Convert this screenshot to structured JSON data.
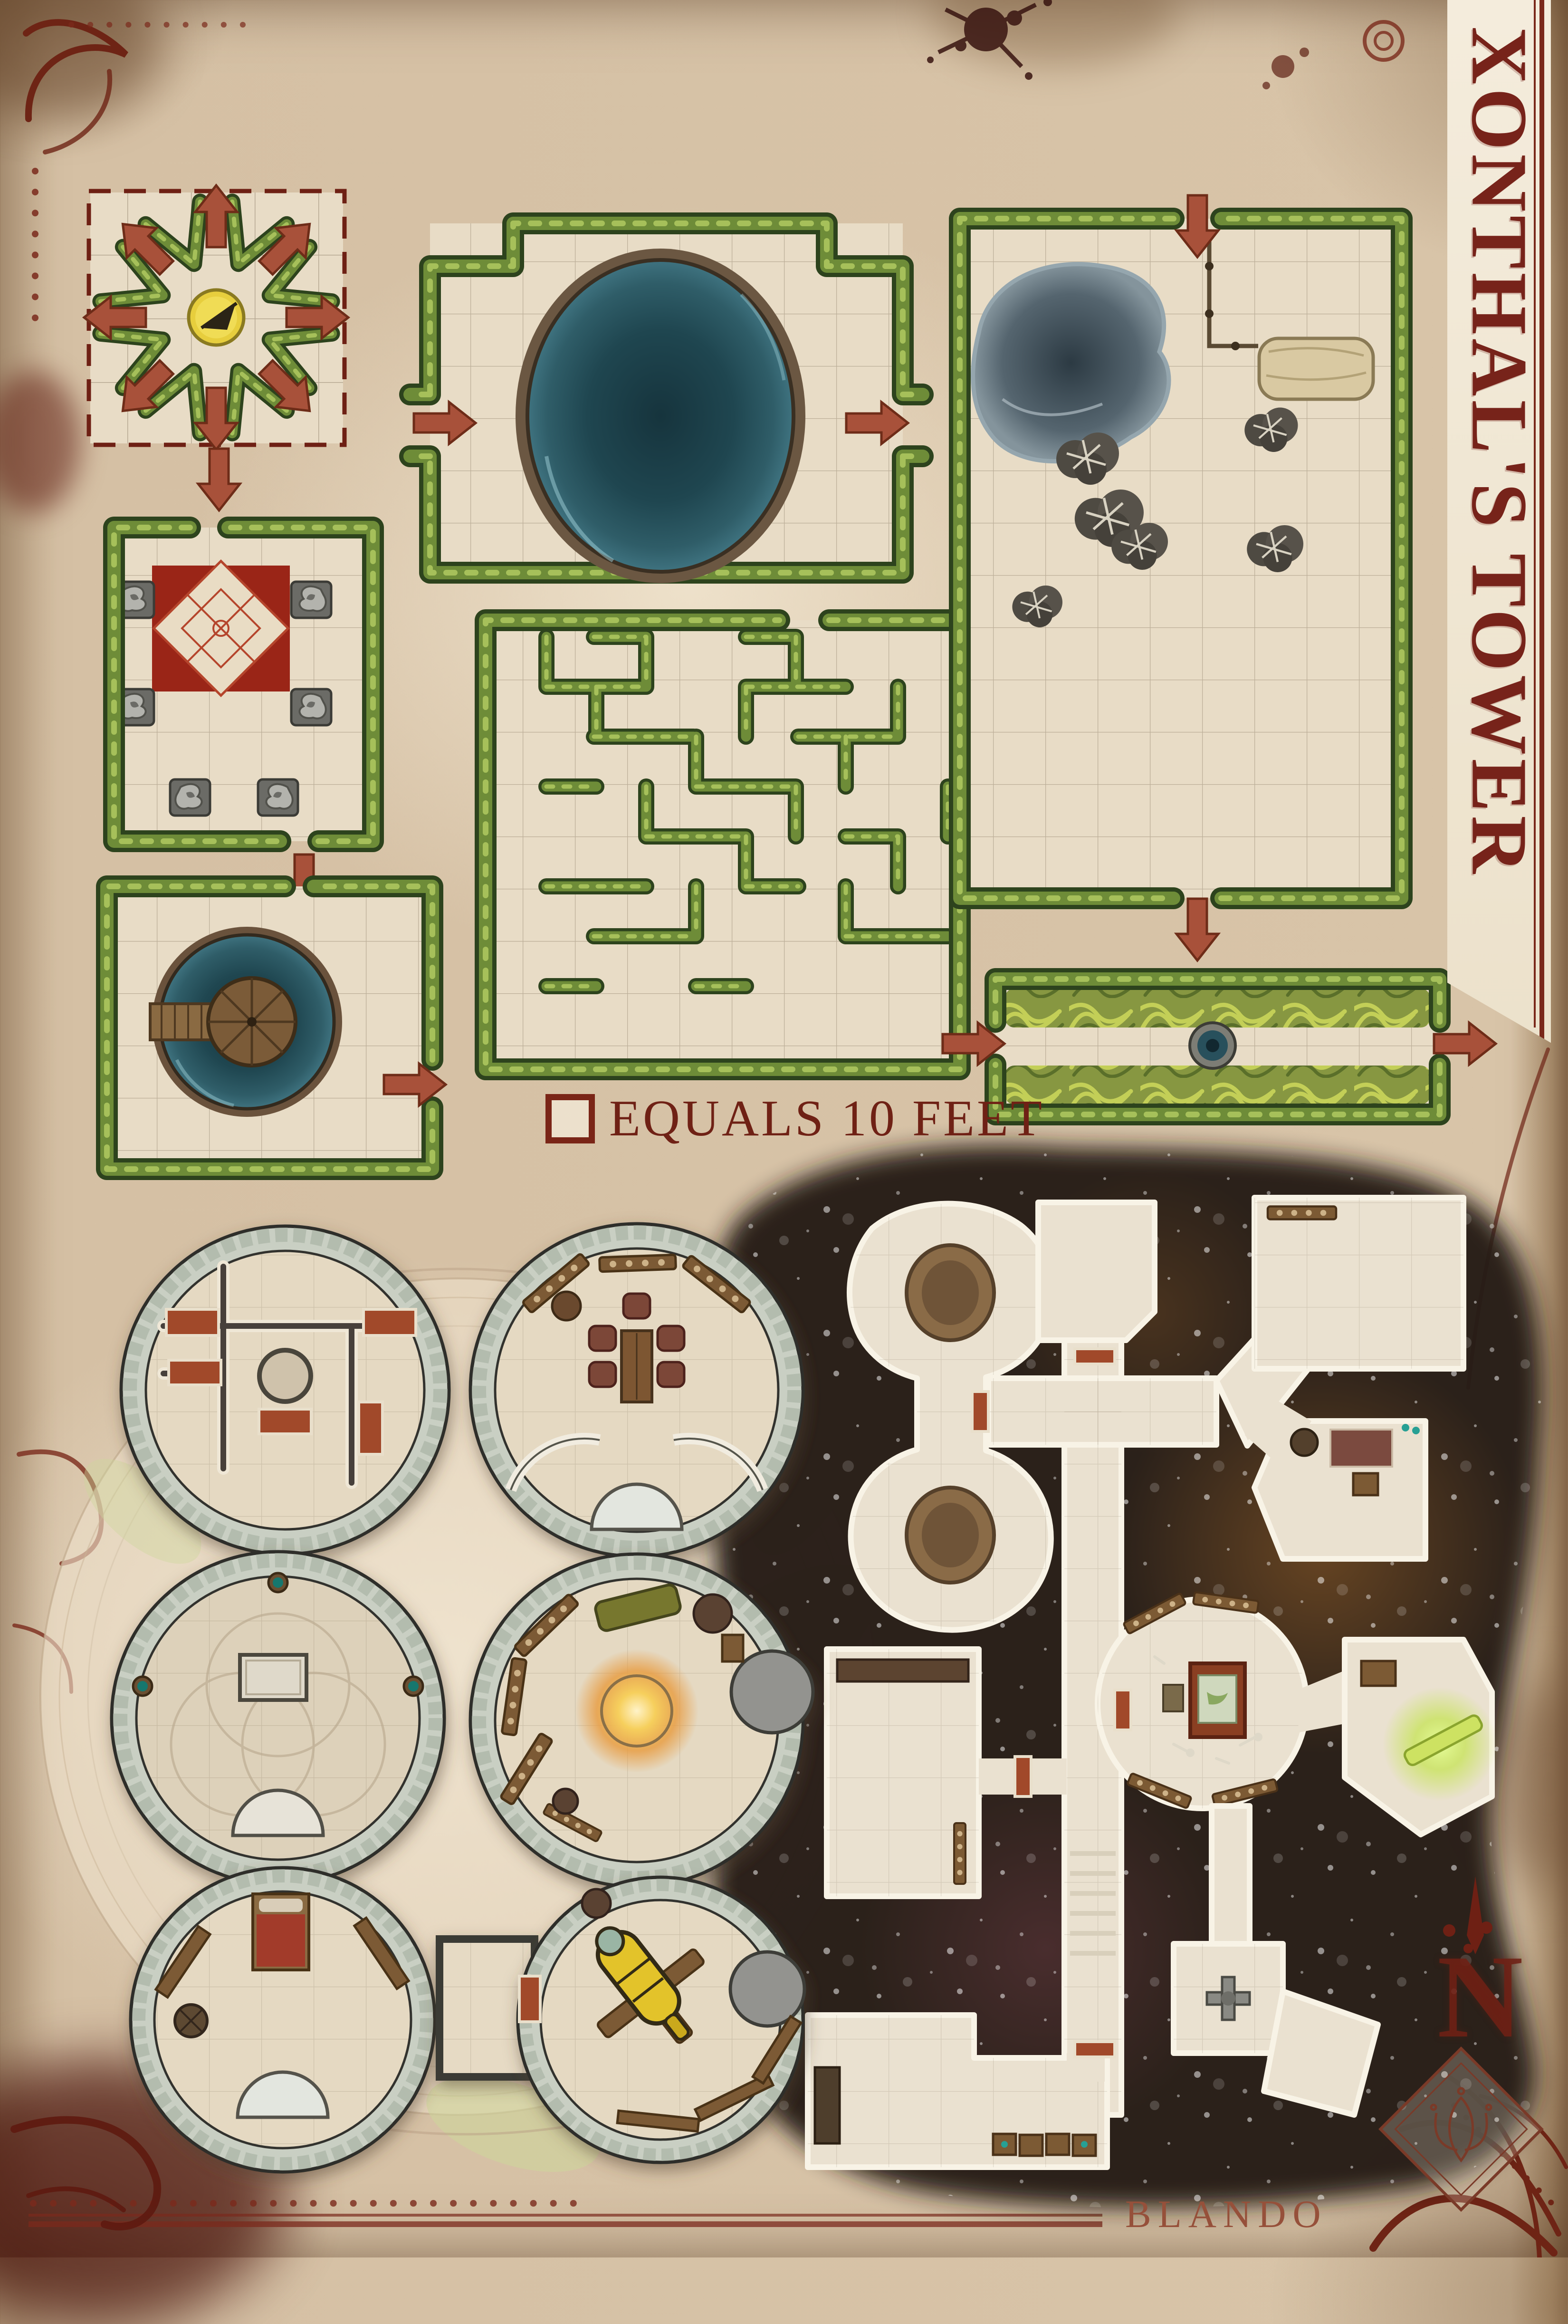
{
  "title": {
    "text": "XONTHAL'S TOWER"
  },
  "legend": {
    "symbol": "grid-square",
    "text": "EQUALS 10 FEET"
  },
  "credit": {
    "text": "BLANDO"
  },
  "compass": {
    "letter": "N",
    "direction": "north"
  },
  "palette": {
    "parchment": "#d5c0a4",
    "accent_maroon": "#77231a",
    "arrow_red": "#a8513a",
    "hedge_green": "#6e8c38",
    "pool_teal": "#1f4650",
    "carpet_red": "#9a2517",
    "tower_ring_gray": "#c9cfc3",
    "dungeon_dark": "#261c12",
    "gold": "#e3c32b"
  },
  "map": {
    "garden_features": [
      {
        "id": "teleport-hub",
        "label": "Dashed hedge hub with eight outward arrows and a central sundial"
      },
      {
        "id": "reflecting-pool-garden",
        "label": "Hedged garden with large dark oval pool, entry and exit arrows"
      },
      {
        "id": "gargoyle-garden",
        "label": "Hedged garden with red patterned carpet and six gargoyle statues"
      },
      {
        "id": "island-pool-garden",
        "label": "Hedged garden with round pool, wooden platform and pier"
      },
      {
        "id": "hedge-maze",
        "label": "Square hedge maze"
      },
      {
        "id": "wild-garden",
        "label": "Hedged yard with pond, fence, hay bale and thorn bushes"
      },
      {
        "id": "vine-corridor",
        "label": "Overgrown hedge corridor with central well and through arrows"
      }
    ],
    "tower_floors": [
      {
        "id": "tower-floor-barracks",
        "label": "Partitioned floor with central shaft and five red cots"
      },
      {
        "id": "tower-floor-dining",
        "label": "Dining floor with table, five chairs, sideboards and twin stairs"
      },
      {
        "id": "tower-floor-ritual",
        "label": "Ritual floor with pale altar stone and three teal braziers"
      },
      {
        "id": "tower-floor-study",
        "label": "Study floor with glowing hearth, couch and bookshelves"
      },
      {
        "id": "tower-floor-bedroom",
        "label": "Bedroom floor with red bed, benches and drum table"
      },
      {
        "id": "tower-floor-observatory",
        "label": "Observatory floor with golden telescope on timber mount"
      },
      {
        "id": "tower-annex",
        "label": "Small square annex room with red door"
      }
    ],
    "dungeon_features": [
      {
        "id": "twin-dais-chamber",
        "label": "Figure-eight chamber with two round brown daises"
      },
      {
        "id": "corridor-cross",
        "label": "Crossing corridors with red doors and a stair"
      },
      {
        "id": "storeroom",
        "label": "Upper-right store room with shelf"
      },
      {
        "id": "workroom",
        "label": "Room with rug, round table and crate"
      },
      {
        "id": "map-study",
        "label": "Round study with map table, shelves and scattered bones"
      },
      {
        "id": "glow-chamber",
        "label": "Chamber with glowing green bar"
      },
      {
        "id": "long-hall",
        "label": "Hall with long table"
      },
      {
        "id": "crate-room",
        "label": "L-shaped room with crates"
      },
      {
        "id": "shrine-room",
        "label": "Small room with cross-shaped fixture"
      }
    ]
  }
}
